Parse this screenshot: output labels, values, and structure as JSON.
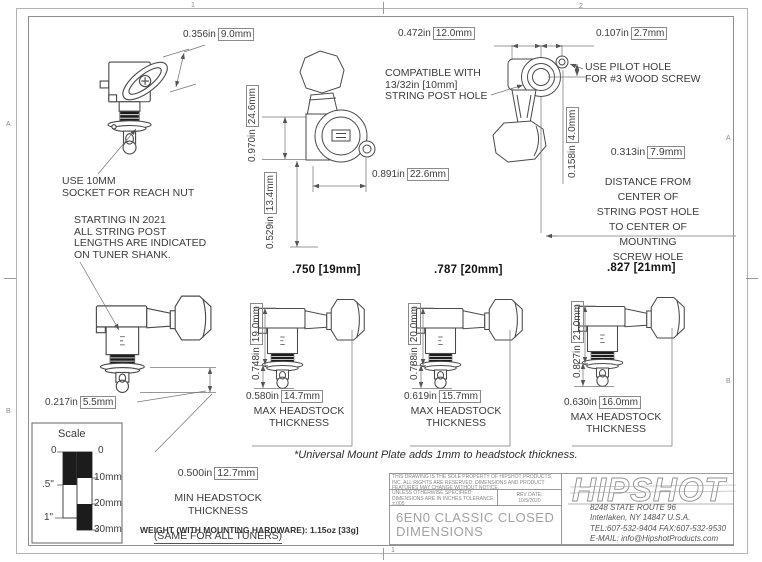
{
  "zones": {
    "top_1": "1",
    "top_2": "2",
    "bottom_1": "1",
    "left_a": "A",
    "left_b": "B",
    "right_a": "A",
    "right_b": "B"
  },
  "dims": {
    "button_width": {
      "in": "0.356in",
      "mm": "9.0mm"
    },
    "overall_height": {
      "in": "0.970in",
      "mm": "24.6mm"
    },
    "body_height": {
      "in": "0.529in",
      "mm": "13.4mm"
    },
    "overall_width": {
      "in": "0.891in",
      "mm": "22.6mm"
    },
    "housing_width": {
      "in": "0.472in",
      "mm": "12.0mm"
    },
    "pilot_offset_h": {
      "in": "0.107in",
      "mm": "2.7mm"
    },
    "pilot_offset_v": {
      "in": "0.158in",
      "mm": "4.0mm"
    },
    "post_tip": {
      "in": "0.217in",
      "mm": "5.5mm"
    },
    "post_to_screw": {
      "in": "0.313in",
      "mm": "7.9mm"
    },
    "min_headstock": {
      "in": "0.500in",
      "mm": "12.7mm"
    }
  },
  "notes": {
    "reach_nut": "USE 10MM\nSOCKET FOR REACH NUT",
    "post_lengths_2021": "STARTING IN 2021\nALL STRING POST\nLENGTHS ARE INDICATED\nON TUNER SHANK.",
    "string_post_hole": "COMPATIBLE WITH\n13/32in [10mm]\nSTRING POST HOLE",
    "pilot_hole": "USE PILOT HOLE\nFOR #3 WOOD SCREW",
    "post_to_screw_body": "DISTANCE FROM\nCENTER OF\nSTRING POST HOLE\nTO CENTER OF\nMOUNTING\nSCREW HOLE",
    "min_headstock_lines": "MIN HEADSTOCK\nTHICKNESS",
    "min_headstock_same": "(SAME FOR ALL TUNERS)",
    "max_headstock": "MAX HEADSTOCK\nTHICKNESS",
    "universal_mount": "*Universal Mount Plate adds 1mm to headstock thickness.",
    "weight": "WEIGHT (WITH MOUNTING HARDWARE): 1.15oz [33g]"
  },
  "variants": [
    {
      "title": ".750 [19mm]",
      "post_len": {
        "in": "0.748in",
        "mm": "19.0mm"
      },
      "max_headstock": {
        "in": "0.580in",
        "mm": "14.7mm"
      }
    },
    {
      "title": ".787 [20mm]",
      "post_len": {
        "in": "0.788in",
        "mm": "20.0mm"
      },
      "max_headstock": {
        "in": "0.619in",
        "mm": "15.7mm"
      }
    },
    {
      "title": ".827 [21mm]",
      "post_len": {
        "in": "0.827in",
        "mm": "21.0mm"
      },
      "max_headstock": {
        "in": "0.630in",
        "mm": "16.0mm"
      }
    }
  ],
  "scale_box": {
    "title": "Scale",
    "inch": [
      "0",
      ".5\"",
      "1\""
    ],
    "mm": [
      "0",
      "10mm",
      "20mm",
      "30mm"
    ]
  },
  "title_block": {
    "property_note": "THIS DRAWING IS THE SOLE PROPERTY OF HIPSHOT PRODUCTS, INC. ALL RIGHTS ARE RESERVED. DIMENSIONS AND PRODUCT FEATURES MAY CHANGE WITHOUT NOTICE.",
    "spec_note": "UNLESS OTHERWISE SPECIFIED: DIMENSIONS ARE IN INCHES TOLERANCE: ±.005",
    "rev_label": "REV DATE:",
    "rev_date": "10/5/2020",
    "part_title": "6EN0 CLASSIC CLOSED\nDIMENSIONS",
    "brand": "HIPSHOT",
    "address": [
      "8248 STATE ROUTE 96",
      "Interlaken, NY 14847 U.S.A.",
      "TEL:607-532-9404 FAX:607-532-9530",
      "E-MAIL: info@HipshotProducts.com"
    ]
  }
}
